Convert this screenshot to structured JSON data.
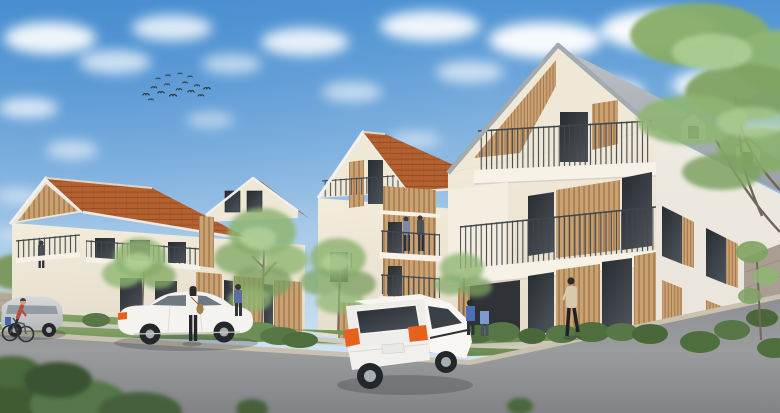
{
  "scene": {
    "description": "Daylight architectural rendering of a residential complex: three connected apartment buildings with pitched terracotta-tile and zinc roofs, cream facades, vertical timber-slat cladding and steel balconies; foreground asphalt parking with a white sedan, a white hatchback, a silver minivan and a cyclist; pedestrians, residents on balconies, street trees, a large overhanging tree, blue sky with scattered clouds and a flock of birds.",
    "sky": {
      "elements": [
        "blue gradient sky",
        "scattered cumulus clouds",
        "flock of birds"
      ],
      "bird_count": 16
    },
    "buildings": [
      {
        "id": "left",
        "roof": "terracotta tiles",
        "features": [
          "timber-lined gable loggia",
          "balcony with metal railing",
          "dormer gable with two windows",
          "timber-slat ground-floor panels",
          "resident on loggia balcony"
        ]
      },
      {
        "id": "middle",
        "roof": "terracotta tiles",
        "features": [
          "street-facing gable with attic railing",
          "timber-clad balcony bay",
          "two residents on balcony",
          "tall gable window"
        ]
      },
      {
        "id": "right",
        "roof": "zinc grey",
        "features": [
          "large street-facing gable with timber-slat soffit",
          "recessed attic balcony",
          "full-width balcony with steel railing",
          "timber-slat panels between floor-to-ceiling windows",
          "shuttered side windows",
          "two roof dormers"
        ]
      }
    ],
    "vehicles": [
      {
        "type": "white sedan",
        "position": "center-left foreground"
      },
      {
        "type": "white hatchback",
        "position": "center-right foreground"
      },
      {
        "type": "silver minivan",
        "position": "far left"
      },
      {
        "type": "bicycle with rider",
        "position": "far left edge"
      }
    ],
    "people": [
      {
        "type": "woman with shoulder bag",
        "position": "beside white sedan"
      },
      {
        "type": "pedestrian in blue",
        "position": "walkway behind sedan"
      },
      {
        "type": "two children",
        "position": "in front of right building"
      },
      {
        "type": "walking woman",
        "position": "right building walkway"
      },
      {
        "type": "two residents",
        "position": "middle building balcony"
      },
      {
        "type": "resident",
        "position": "left building loggia"
      }
    ],
    "landscape": [
      "street trees in front of facades",
      "large overhanging tree upper right",
      "low stone walls",
      "hedges and shrubs",
      "grass verge and slope",
      "asphalt parking area"
    ]
  },
  "palette": {
    "sky_top": "#4f93d3",
    "sky_mid": "#a6c9e8",
    "sky_horizon": "#e2eef7",
    "cloud": "#ffffff",
    "roof_tile": "#b5612f",
    "roof_tile_shade": "#8a4722",
    "roof_zinc_light": "#bcc2c8",
    "roof_zinc_dark": "#99a0a6",
    "bargeboard": "#9aa1a7",
    "facade_light": "#f3ecdb",
    "facade_shade": "#e5ddcc",
    "facade_side": "#e9e5dc",
    "wood": "#c9a172",
    "wood_stripe": "#9e744a",
    "window_dark": "#272c31",
    "window_light": "#4a5158",
    "railing": "#42474d",
    "slab": "#f6f2e8",
    "asphalt_top": "#8e9093",
    "asphalt_mid": "#9a9c9e",
    "asphalt_bottom": "#818386",
    "walkway": "#cfc9bb",
    "kerb": "#c9c2b0",
    "grass_light": "#84a468",
    "grass_dark": "#6a8a50",
    "bush": "#4f6e3d",
    "tree": "#8fb573",
    "tree_light": "#b7d69c",
    "stone_wall": "#b2a996",
    "trunk": "#75695a",
    "car_white": "#f4f3f0",
    "car_silver": "#d8dadb",
    "taillight": "#e8611c",
    "car_glass": "#6f7a80",
    "bird": "#2f3033"
  }
}
